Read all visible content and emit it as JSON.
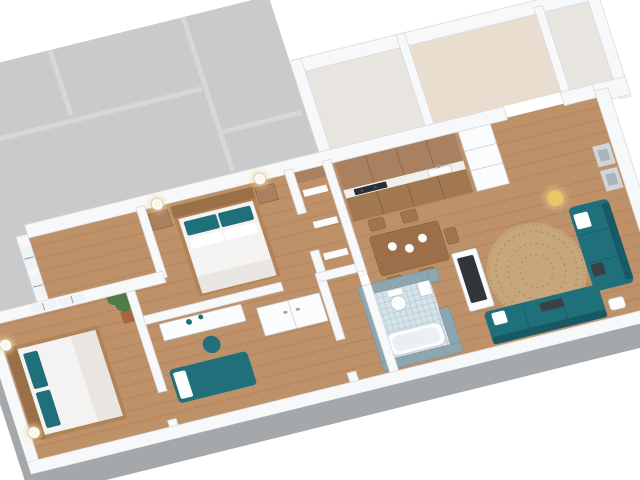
{
  "scene": {
    "label": "3D isometric cutaway floor plan render of a furnished apartment",
    "background": "#ffffff"
  },
  "rooms": [
    {
      "name": "neighboring-unit-slab"
    },
    {
      "name": "entry-hall"
    },
    {
      "name": "utility-room"
    },
    {
      "name": "storage-room"
    },
    {
      "name": "kitchen"
    },
    {
      "name": "dining-area"
    },
    {
      "name": "living-room"
    },
    {
      "name": "bathroom"
    },
    {
      "name": "hallway"
    },
    {
      "name": "closet"
    },
    {
      "name": "dressing-room"
    },
    {
      "name": "master-bedroom"
    },
    {
      "name": "office-bedroom"
    },
    {
      "name": "second-bedroom"
    }
  ],
  "furniture": [
    "kitchen-cabinets",
    "cooktop",
    "kitchen-sink",
    "tall-cabinet",
    "dining-table",
    "dining-chairs",
    "dinner-plates",
    "round-rug",
    "tv-stand",
    "tv-screen",
    "teal-sofa-right",
    "teal-sofa-bottom",
    "floor-lamp",
    "wall-art",
    "ottoman",
    "office-desk",
    "desk-chair",
    "sideboard",
    "teal-daybed",
    "master-double-bed",
    "nightstands",
    "wall-sconces",
    "second-double-bed",
    "potted-plant",
    "toilet",
    "bathtub",
    "bathroom-sink",
    "windows"
  ],
  "colors": {
    "background": "#ffffff",
    "slab": "#c8cacc",
    "slab_lines": "#d6d8da",
    "wall": "#f7f8f9",
    "wall_side": "#a4a8ab",
    "wood_floor": "#bf9169",
    "plank_line": "rgba(92,56,24,0.16)",
    "entry_floor": "#e9ddcf",
    "utility_floor": "#e8e5e1",
    "cabinet_wood": "#aa8160",
    "counter_top": "#f2f0ec",
    "counter_base": "#a1784f",
    "cooktop": "#2b2f33",
    "burner": "#4a5055",
    "table_wood": "#9c6f4a",
    "chair_wood": "#a0764e",
    "teal": "#20707c",
    "teal_dark": "#175a66",
    "rug": "#c8a67c",
    "rug_ring": "#a9885e",
    "bath_wall": "#8ea6b0",
    "bath_tile": "#d6e4ea",
    "bath_grid": "#b7ccd4",
    "fixture_white": "#fbfcfd",
    "tub_inner": "#e9eff2",
    "bed_frame": "#b08457",
    "headboard_dark": "#9a7048",
    "mattress": "#f4f3f1",
    "blanket": "#e9e6e2",
    "pillow_white": "#ffffff",
    "pillow_dark": "#394046",
    "glow": "#ffd98f",
    "sconce_core": "#fff6dc",
    "lamp_shade": "#e9c766",
    "lamp_stand": "#9aa0a4",
    "plant_green": "#4d7c48",
    "plant_pot": "#a9653f",
    "tv_dark": "#30363a",
    "art_gray": "#cfd5d8",
    "art_inner": "#aab3b8",
    "window_glass": "#eef3f6",
    "seam": "rgba(0,0,0,0.18)",
    "cab_seam": "rgba(60,35,15,0.25)"
  }
}
